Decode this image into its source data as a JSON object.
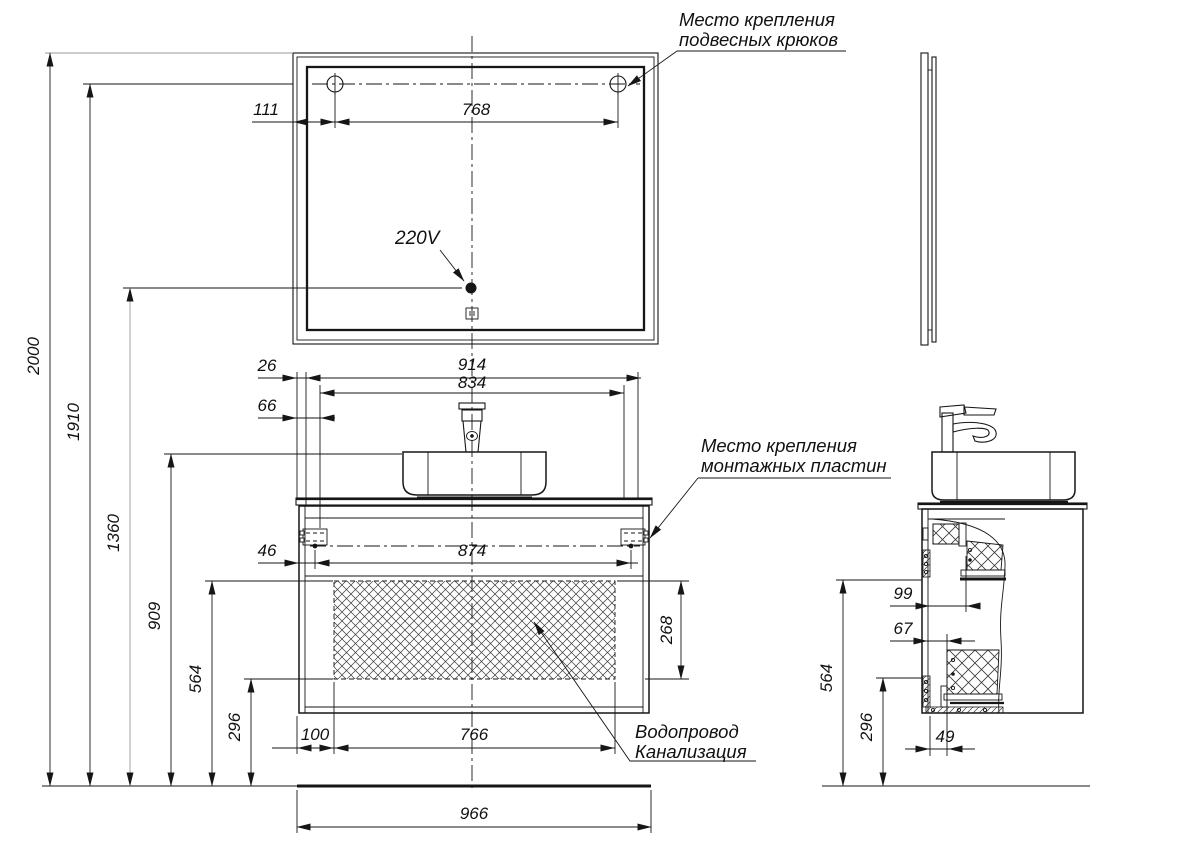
{
  "colors": {
    "line": "#161616",
    "dimension": "#161616",
    "light_gray_line": "#9a9a9a",
    "background": "#ffffff"
  },
  "labels": {
    "hooks_line1": "Место крепления",
    "hooks_line2": "подвесных крюков",
    "plates_line1": "Место крепления",
    "plates_line2": "монтажных пластин",
    "voltage": "220V",
    "water_line1": "Водопровод",
    "water_line2": "Канализация"
  },
  "dims": {
    "mirror_hook_offset": "111",
    "mirror_hook_span": "768",
    "h2000": "2000",
    "h1910": "1910",
    "h1360": "1360",
    "h909": "909",
    "h564": "564",
    "h296": "296",
    "top26": "26",
    "top914": "914",
    "top834": "834",
    "top66": "66",
    "mid46": "46",
    "mid874": "874",
    "bot100": "100",
    "bot766": "766",
    "right268": "268",
    "base966": "966",
    "side99": "99",
    "side67": "67",
    "side49": "49",
    "side564": "564",
    "side296": "296"
  }
}
